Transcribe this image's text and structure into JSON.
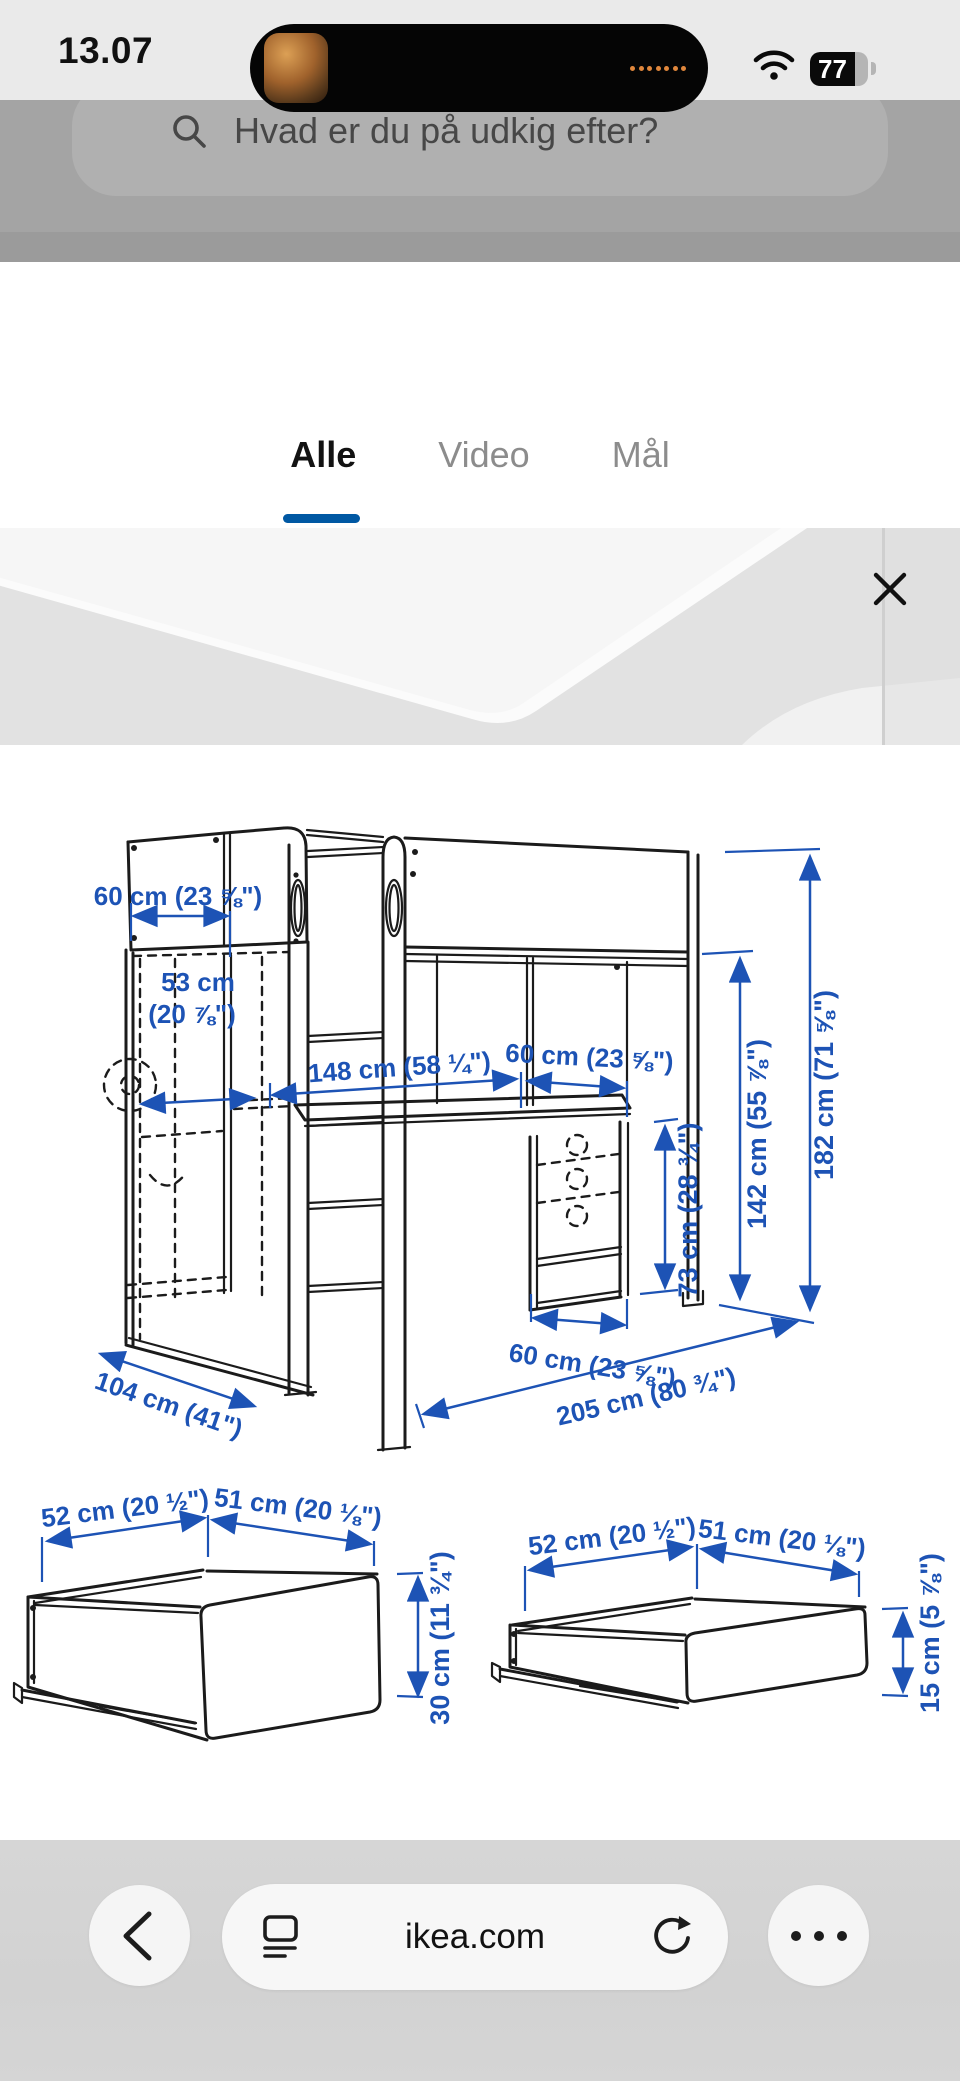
{
  "status_bar": {
    "time": "13.07",
    "battery_level": "77"
  },
  "page_background": {
    "search_placeholder": "Hvad er du på udkig efter?"
  },
  "modal": {
    "tabs": [
      {
        "label": "Alle",
        "active": true
      },
      {
        "label": "Video",
        "active": false
      },
      {
        "label": "Mål",
        "active": false
      }
    ]
  },
  "diagram": {
    "bed_dims": {
      "top_width": "60 cm (23 ⅝\")",
      "inner_width_line1": "53 cm",
      "inner_width_line2": "(20 ⅞\")",
      "bed_length": "148 cm (58 ¼\")",
      "desk_width": "60 cm (23 ⅝\")",
      "height_under_bed": "142 cm (55 ⅞\")",
      "total_height": "182 cm (71 ⅝\")",
      "desk_height": "73 cm (28 ¾\")",
      "chest_depth": "60 cm (23 ⅝\")",
      "total_length": "205 cm (80 ¾\")",
      "side_depth": "104 cm (41\")"
    },
    "drawer_large": {
      "width_a": "52 cm (20 ½\")",
      "width_b": "51 cm (20 ⅛\")",
      "height": "30 cm (11 ¾\")"
    },
    "drawer_small": {
      "width_a": "52 cm (20 ½\")",
      "width_b": "51 cm (20 ⅛\")",
      "height": "15 cm (5 ⅞\")"
    }
  },
  "toolbar": {
    "url": "ikea.com"
  },
  "icons": {
    "more_dots": "•••"
  },
  "colors": {
    "dimension_blue": "#1d53b5",
    "tab_underline_blue": "#0058a3",
    "island_dot_orange": "#e0873c",
    "toolbar_grey": "#d3d3d3"
  }
}
